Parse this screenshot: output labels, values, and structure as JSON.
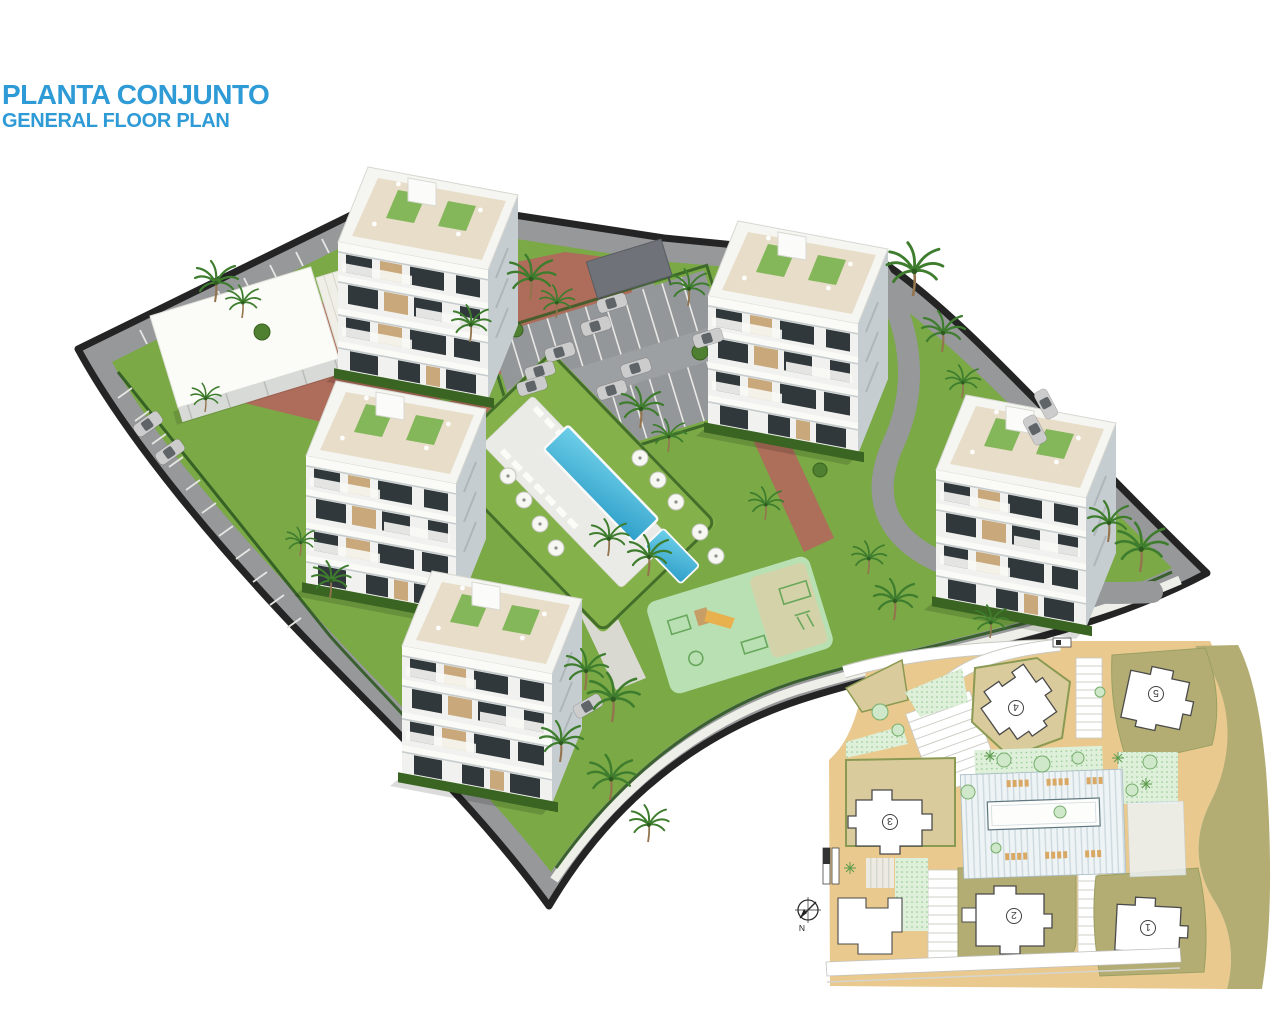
{
  "header": {
    "title": "PLANTA CONJUNTO",
    "subtitle": "GENERAL FLOOR PLAN"
  },
  "site_plan_inset": {
    "buildings": [
      {
        "label": "1"
      },
      {
        "label": "2"
      },
      {
        "label": "3"
      },
      {
        "label": "4"
      },
      {
        "label": "5"
      }
    ],
    "compass": {
      "label": "N"
    }
  },
  "colors": {
    "accent_blue": "#2e9bd6",
    "grass": "#7aa946",
    "asphalt": "#96989a",
    "perimeter_wall": "#242424",
    "brick_path": "#b2675c",
    "pool_water": "#45b8dc",
    "pool_deck": "#eaebe7",
    "playground": "#b9e0b3",
    "building_white": "#f4f5f2",
    "inset_road_tan": "#eac98f",
    "inset_plot_olive": "#b3ad74",
    "inset_garden_green": "#def0da"
  }
}
